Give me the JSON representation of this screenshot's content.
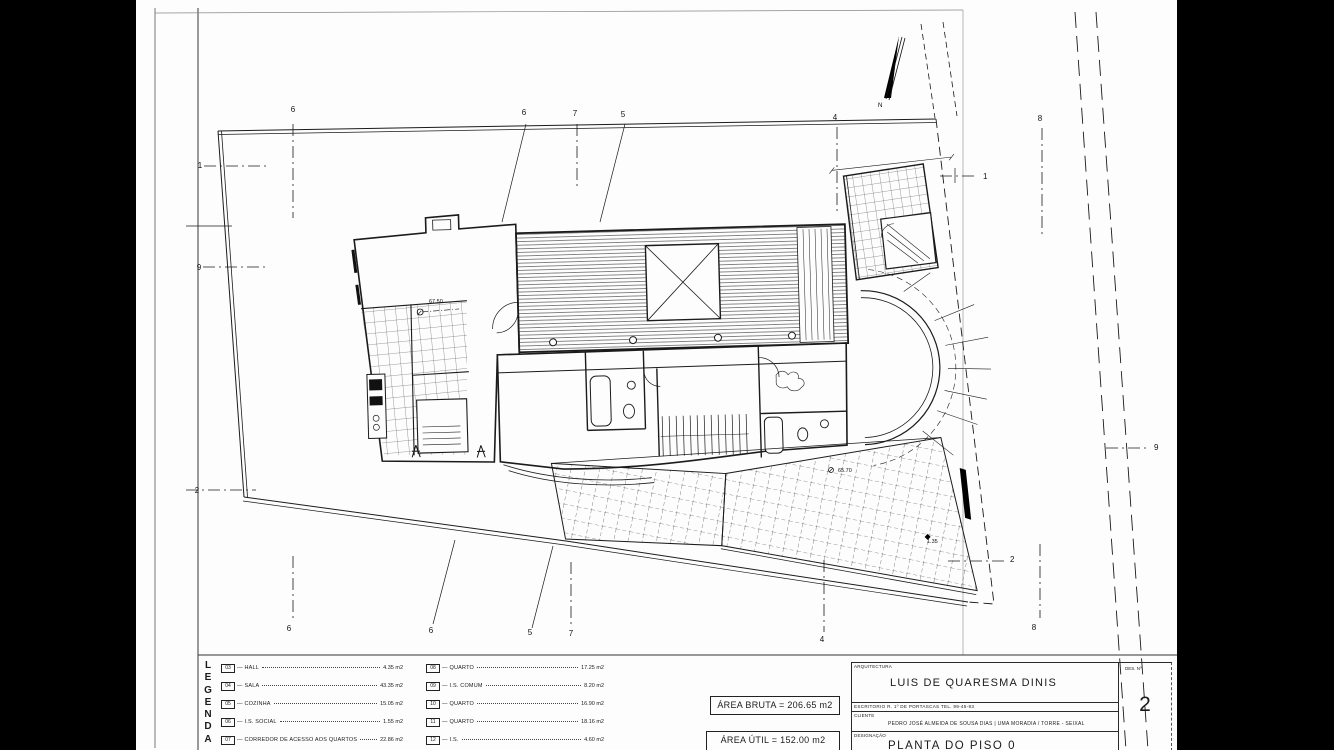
{
  "legend": {
    "title_letters": [
      "L",
      "E",
      "G",
      "E",
      "N",
      "D",
      "A"
    ],
    "dash": "—",
    "columns": [
      {
        "items": [
          {
            "num": "03",
            "label": "HALL",
            "area": "4.35 m2"
          },
          {
            "num": "04",
            "label": "SALA",
            "area": "43.35 m2"
          },
          {
            "num": "05",
            "label": "COZINHA",
            "area": "15.05 m2"
          },
          {
            "num": "06",
            "label": "I.S. SOCIAL",
            "area": "1.55 m2"
          },
          {
            "num": "07",
            "label": "CORREDOR DE ACESSO AOS QUARTOS",
            "area": "22.86 m2"
          }
        ]
      },
      {
        "items": [
          {
            "num": "08",
            "label": "QUARTO",
            "area": "17.25 m2"
          },
          {
            "num": "09",
            "label": "I.S. COMUM",
            "area": "8.20 m2"
          },
          {
            "num": "10",
            "label": "QUARTO",
            "area": "16.90 m2"
          },
          {
            "num": "11",
            "label": "QUARTO",
            "area": "18.16 m2"
          },
          {
            "num": "12",
            "label": "I.S.",
            "area": "4.60 m2"
          }
        ]
      }
    ]
  },
  "areas": {
    "bruta": "ÁREA BRUTA = 206.65 m2",
    "util": "ÁREA ÚTIL = 152.00 m2"
  },
  "title_block": {
    "arquitectura_label": "ARQUITECTURA",
    "architect": "LUIS DE QUARESMA DINIS",
    "escritorio_line": "ESCRITORIO   R. 1º DE  PORTASCAS   TEL. 99-45-93",
    "cliente_label": "CLIENTE",
    "client_line": "PEDRO JOSÉ ALMEIDA DE SOUSA DIAS | UMA MORADIA / TORRE - SEIXAL",
    "designacao_label": "DESIGNAÇÃO",
    "drawing_title": "PLANTA DO PISO 0",
    "sheet_label": "DES. Nº",
    "sheet_number": "2"
  },
  "plan": {
    "north_label": "N",
    "markers": [
      {
        "label": "6"
      },
      {
        "label": "6"
      },
      {
        "label": "7"
      },
      {
        "label": "5"
      },
      {
        "label": "4"
      },
      {
        "label": "8"
      },
      {
        "label": "6"
      },
      {
        "label": "6"
      },
      {
        "label": "5"
      },
      {
        "label": "7"
      },
      {
        "label": "4"
      },
      {
        "label": "8"
      },
      {
        "label": "1"
      },
      {
        "label": "9"
      },
      {
        "label": "2"
      },
      {
        "label": "1"
      },
      {
        "label": "9"
      },
      {
        "label": "2"
      }
    ],
    "spot_levels": [
      {
        "text": "67.50"
      },
      {
        "text": "65.70"
      },
      {
        "text": "1.35"
      }
    ]
  }
}
